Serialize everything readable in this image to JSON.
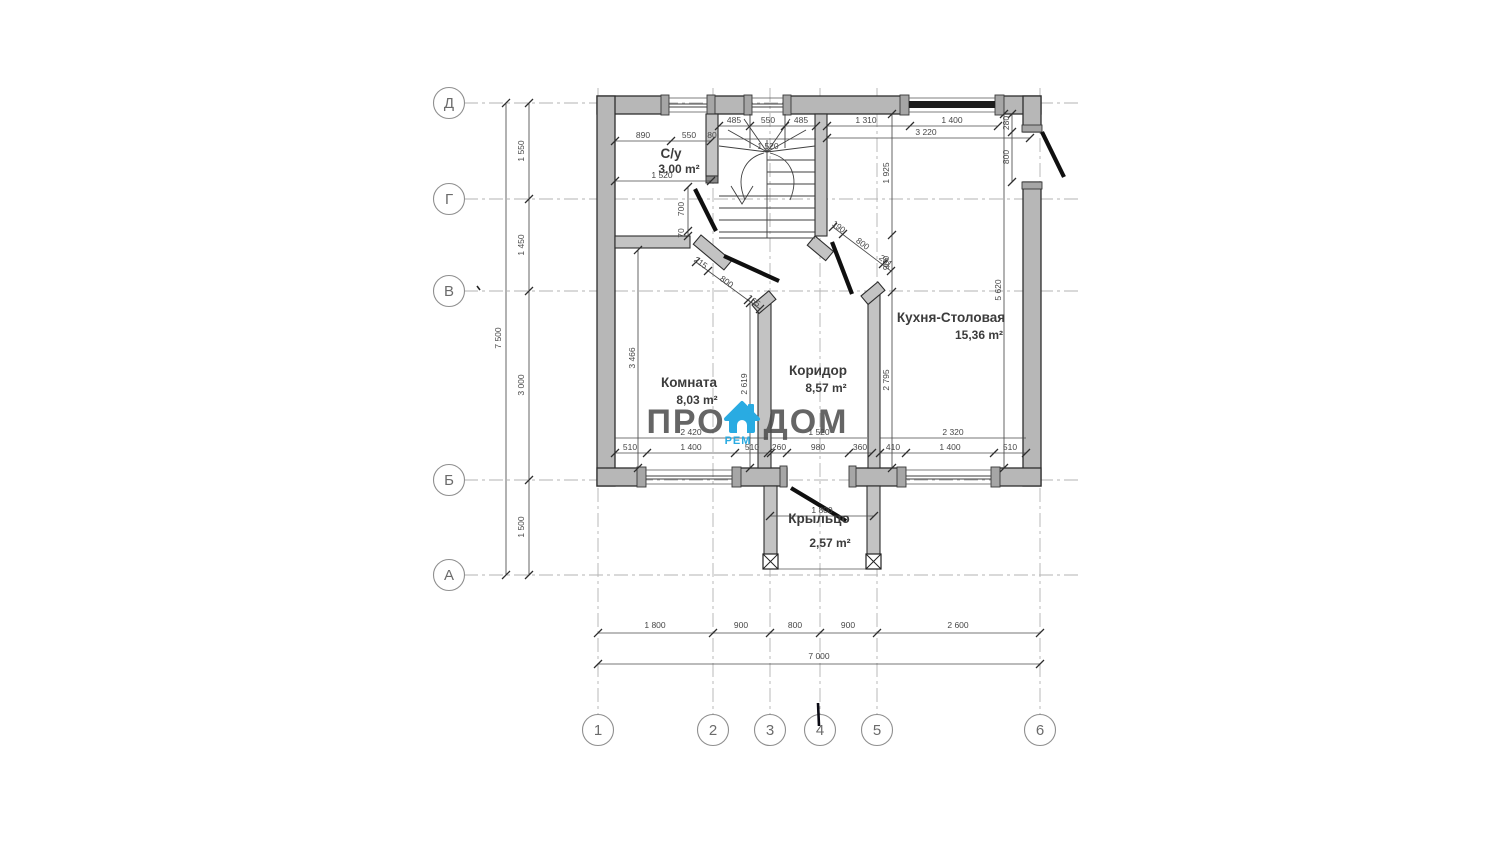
{
  "axes": {
    "rows": [
      "Д",
      "Г",
      "В",
      "Б",
      "А"
    ],
    "cols": [
      "1",
      "2",
      "3",
      "4",
      "5",
      "6"
    ]
  },
  "rooms": {
    "syu": {
      "name": "С/у",
      "area": "3,00 m²"
    },
    "komnata": {
      "name": "Комната",
      "area": "8,03 m²"
    },
    "koridor": {
      "name": "Коридор",
      "area": "8,57 m²"
    },
    "kitchen": {
      "name": "Кухня-Столовая",
      "area": "15,36 m²"
    },
    "porch": {
      "name": "Крыльцо",
      "area": "2,57 m²"
    }
  },
  "dims": {
    "bottom_row": [
      "1 800",
      "900",
      "800",
      "900",
      "2 600"
    ],
    "bottom_total": "7 000",
    "left_col": [
      "1 550",
      "1 450",
      "3 000",
      "1 500"
    ],
    "left_total": "7 500",
    "syu_top": [
      "890",
      "550",
      "80"
    ],
    "syu_width": "1 520",
    "syu_door": [
      "700",
      "70"
    ],
    "stairs_top": [
      "485",
      "550",
      "485"
    ],
    "stairs_width": "1 520",
    "kitchen_top": [
      "1 310",
      "1 400"
    ],
    "kitchen_top_total": "3 220",
    "kitchen_chain": [
      "1 925",
      "900",
      "2 795"
    ],
    "kitchen_height": "5 620",
    "entry_door": [
      "280",
      "800"
    ],
    "kitchen_bottom_total": "2 320",
    "kitchen_bottom": [
      "410",
      "1 400",
      "510"
    ],
    "komnata_height": "3 466",
    "komnata_height_right": "2 619",
    "komnata_bottom_total": "2 420",
    "komnata_bottom": [
      "510",
      "1 400",
      "510"
    ],
    "corridor_bottom_total": "1 520",
    "corridor_bottom": [
      "260",
      "980",
      "360"
    ],
    "komnata_door": [
      "215",
      "800",
      "165"
    ],
    "kitchen_door": [
      "190",
      "800",
      "281"
    ],
    "porch_width": "1 800"
  },
  "watermark": {
    "pro": "ПРО",
    "dom": "ДОМ",
    "sub": "РЕМ"
  },
  "colors": {
    "accent": "#29abe2",
    "wall_fill": "#b7b7b7",
    "line": "#3a3a3a",
    "grid": "#b3b3b3",
    "dim_text": "#474747"
  }
}
